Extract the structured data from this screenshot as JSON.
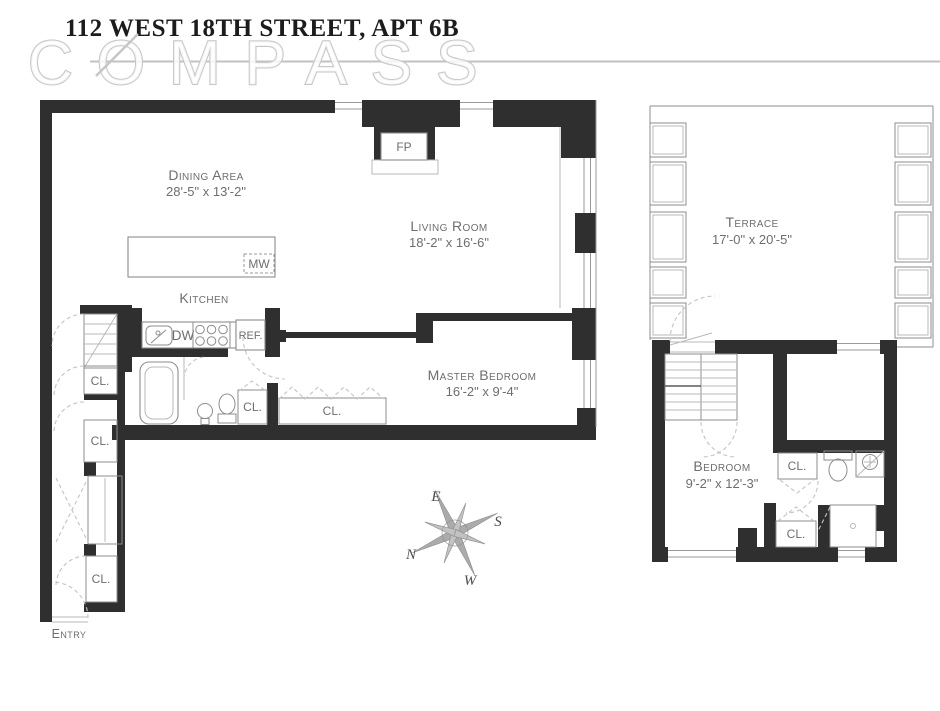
{
  "header": {
    "title": "112 WEST 18TH STREET, APT 6B",
    "watermark": "COMPASS"
  },
  "rooms": {
    "dining": {
      "name": "Dining Area",
      "dims": "28'-5\" x 13'-2\""
    },
    "living": {
      "name": "Living Room",
      "dims": "18'-2\" x 16'-6\""
    },
    "kitchen": {
      "name": "Kitchen"
    },
    "master": {
      "name": "Master Bedroom",
      "dims": "16'-2\" x 9'-4\""
    },
    "terrace": {
      "name": "Terrace",
      "dims": "17'-0\" x 20'-5\""
    },
    "bedroom": {
      "name": "Bedroom",
      "dims": "9'-2\" x 12'-3\""
    },
    "entry": {
      "name": "Entry"
    }
  },
  "fixtures": {
    "fireplace": "FP",
    "microwave": "MW",
    "dishwasher": "DW",
    "refrigerator": "REF.",
    "closet": "CL."
  },
  "compass_rose": {
    "north": "N",
    "east": "E",
    "south": "S",
    "west": "W"
  },
  "colors": {
    "wall": "#2f2f2f",
    "label_gray": "#6e6e6e",
    "planter_green": "#8cba6b",
    "watermark_outline": "#c6c6c6",
    "title_ink": "#1c1c1c"
  }
}
